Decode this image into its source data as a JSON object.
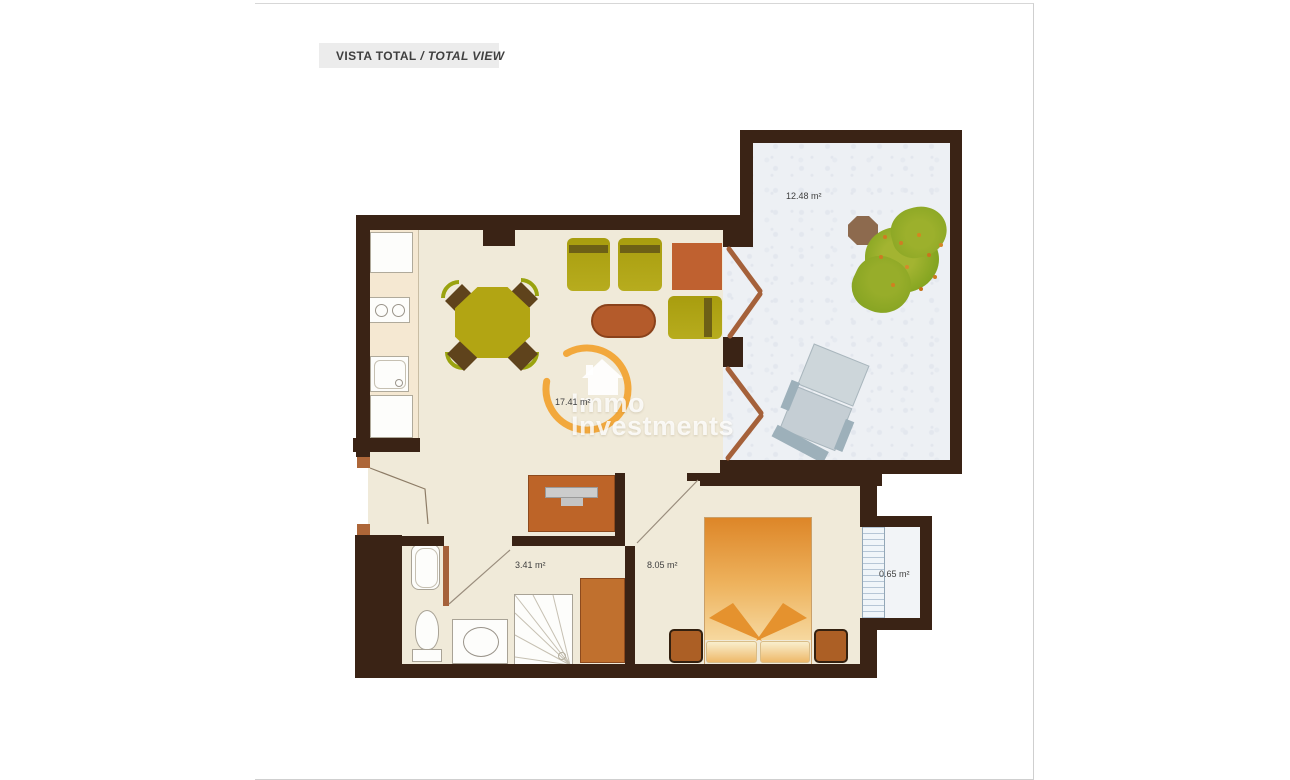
{
  "header": {
    "title_primary": "VISTA TOTAL",
    "title_separator": " / ",
    "title_secondary": "TOTAL VIEW",
    "bar_color": "#ececec",
    "text_color": "#3f3f3f"
  },
  "floorplan": {
    "rooms": {
      "terrace": {
        "area_label": "12.48 m²"
      },
      "living_room": {
        "area_label": "17.41 m²"
      },
      "bathroom": {
        "area_label": "3.41 m²"
      },
      "bedroom": {
        "area_label": "8.05 m²"
      },
      "storage": {
        "area_label": "0.65 m²"
      }
    },
    "colors": {
      "wall": "#3a2315",
      "interior_floor": "#f0ead9",
      "kitchen_counter": "#f5e8d2",
      "terrace_floor": "#edf0f4",
      "door": "#a5613a",
      "furniture_olive": "#b2a513",
      "furniture_orange": "#bf6130",
      "bed_orange": "#dd8628",
      "lounger_blue": "#cdd6da",
      "plant_green": "#85a521",
      "watermark_ring": "#f2a83c"
    }
  },
  "watermark": {
    "line1": "Immo",
    "line2": "Investments"
  }
}
